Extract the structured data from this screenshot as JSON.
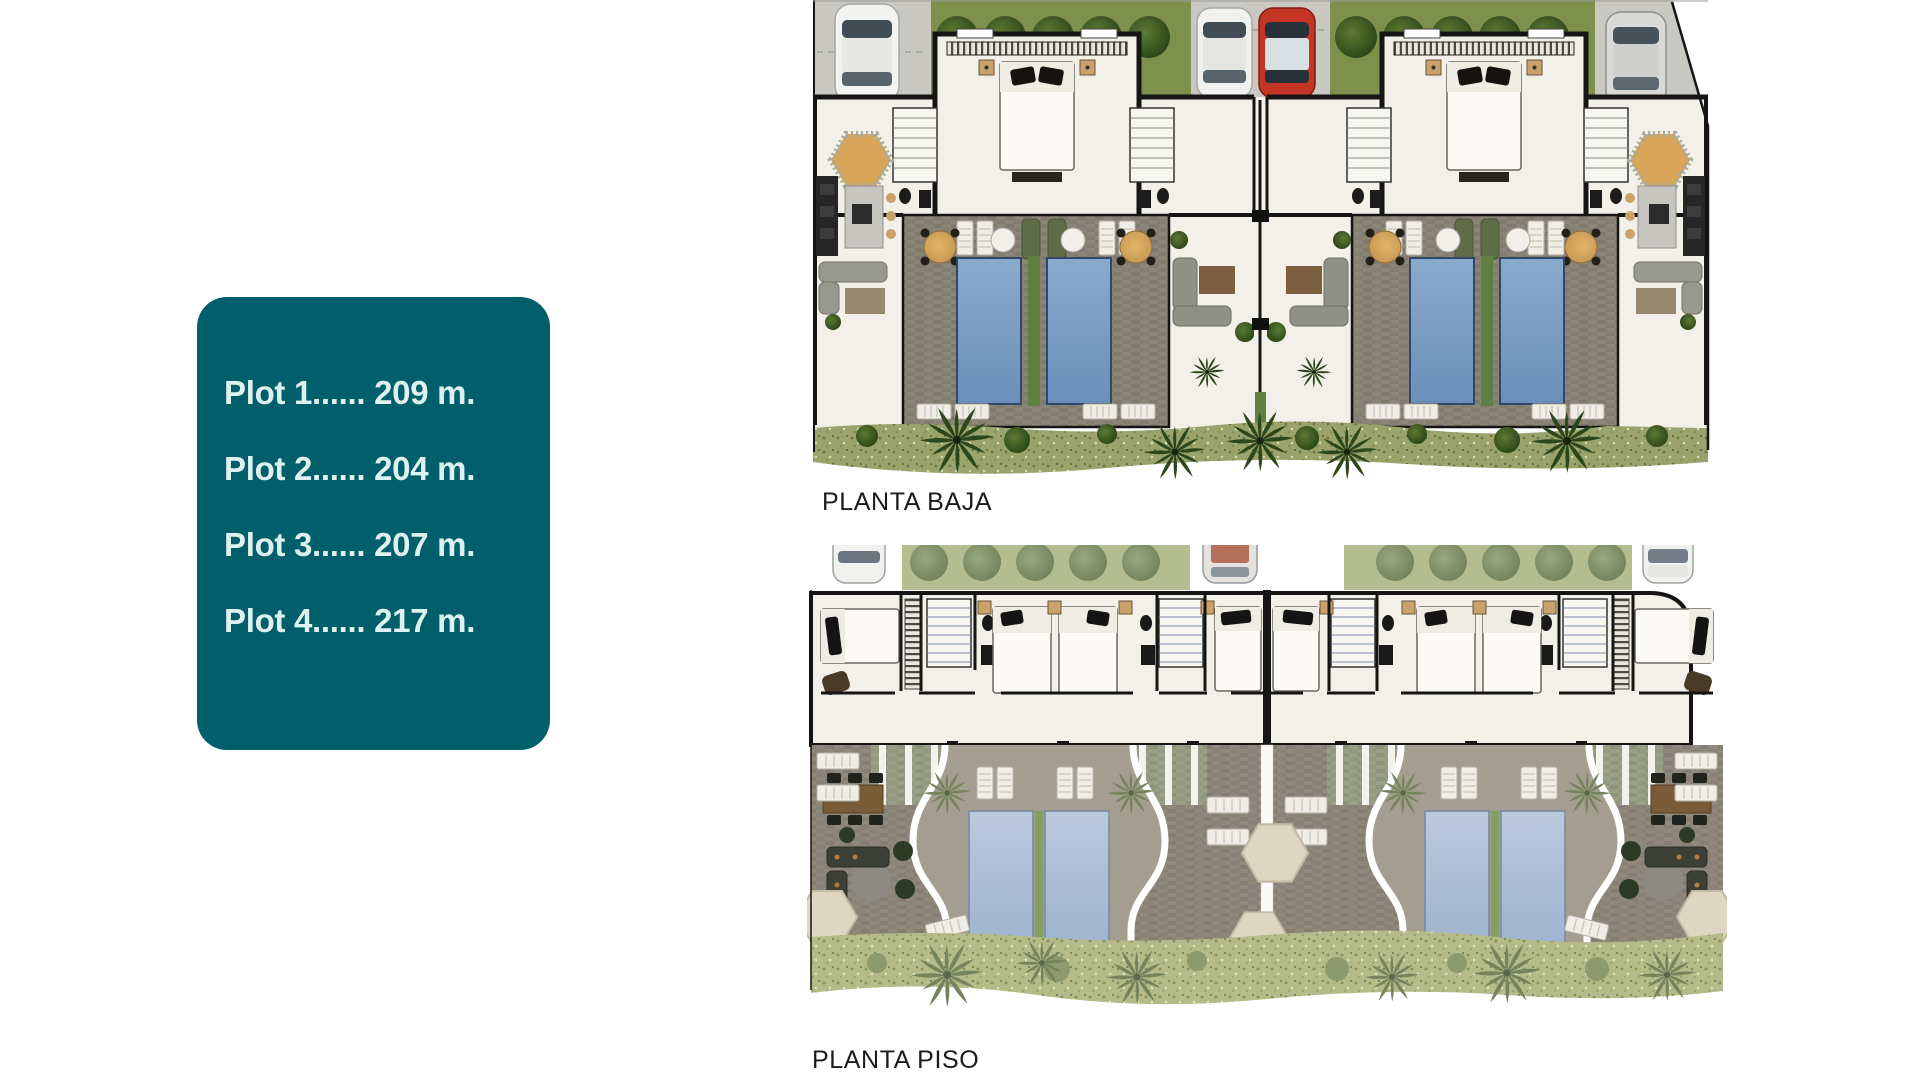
{
  "plot_card": {
    "bg_color": "#005f6b",
    "text_color": "#def1f0",
    "items": [
      {
        "label": "Plot 1...... 209 m."
      },
      {
        "label": "Plot 2...... 204 m."
      },
      {
        "label": "Plot 3...... 207 m."
      },
      {
        "label": "Plot 4...... 217 m."
      }
    ]
  },
  "plans": {
    "ground_floor": {
      "label": "PLANTA BAJA"
    },
    "upper_floor": {
      "label": "PLANTA PISO"
    }
  },
  "palette": {
    "card_bg": "#005f6b",
    "card_text": "#def1f0",
    "wall": "#151515",
    "terrace_stone": "#8b8577",
    "pool_water": "#7b9dc5",
    "upper_pool_water": "#aec0d8",
    "grass": "#7e904c",
    "landscape": "#9aa36b",
    "driveway": "#c9c8c3",
    "car_red": "#c53526",
    "parasol_orange": "#d9a558",
    "parasol_cream": "#ded6c3"
  }
}
